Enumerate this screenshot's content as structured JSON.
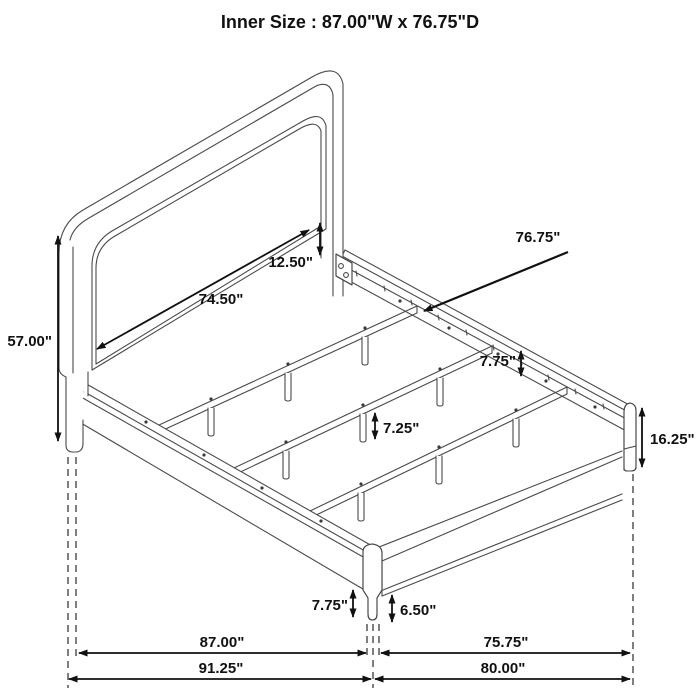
{
  "title": "Inner Size : 87.00\"W x 76.75\"D",
  "dims": {
    "headboard_height": "57.00\"",
    "inner_headboard_width": "74.50\"",
    "panel_to_rail_gap": "12.50\"",
    "inner_depth": "76.75\"",
    "side_rail_height": "7.75\"",
    "center_support_leg_height": "7.25\"",
    "footboard_corner_height": "16.25\"",
    "front_leg_height": "7.75\"",
    "front_leg_lower_height": "6.50\"",
    "bottom_width_inner": "87.00\"",
    "bottom_depth_inner": "75.75\"",
    "bottom_width_outer": "91.25\"",
    "bottom_depth_outer": "80.00\""
  },
  "colors": {
    "line": "#4a4a4a",
    "dimension": "#111111",
    "background": "#ffffff"
  }
}
